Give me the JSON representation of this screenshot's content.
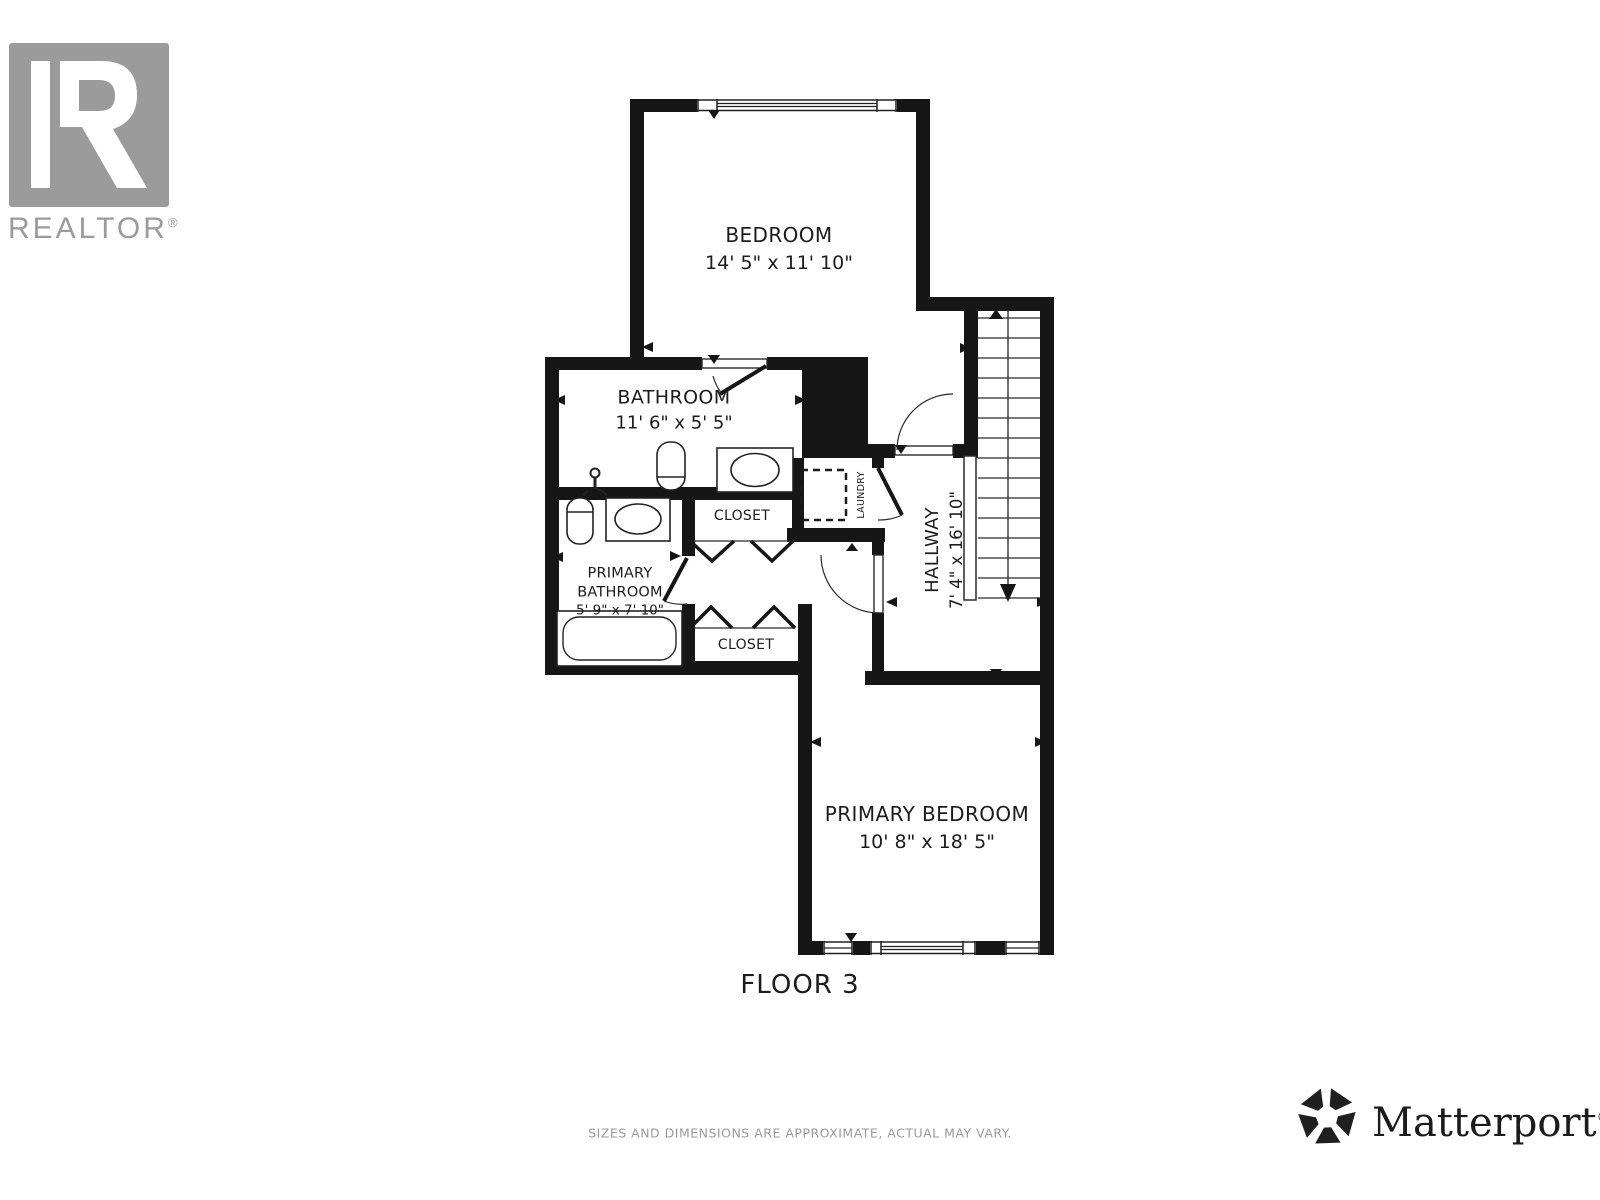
{
  "branding": {
    "realtor_logo_text": "REALTOR",
    "realtor_reg": "®",
    "matterport_text": "Matterport",
    "matterport_reg": "®",
    "logo_gray": "#9b9b9b"
  },
  "floor": {
    "label": "FLOOR 3"
  },
  "disclaimer": "SIZES AND DIMENSIONS ARE APPROXIMATE, ACTUAL MAY VARY.",
  "rooms": {
    "bedroom": {
      "name": "BEDROOM",
      "dims": "14' 5\" x 11' 10\""
    },
    "bathroom": {
      "name": "BATHROOM",
      "dims": "11' 6\" x 5' 5\""
    },
    "primary_bathroom": {
      "name_line1": "PRIMARY",
      "name_line2": "BATHROOM",
      "dims": "5' 9\" x 7' 10\""
    },
    "closet_upper": {
      "name": "CLOSET"
    },
    "closet_lower": {
      "name": "CLOSET"
    },
    "hallway": {
      "name": "HALLWAY",
      "dims": "7' 4\" x 16' 10\""
    },
    "laundry": {
      "name": "LAUNDRY"
    },
    "primary_bedroom": {
      "name": "PRIMARY BEDROOM",
      "dims": "10' 8\" x 18' 5\""
    }
  },
  "icons": {
    "realtor_r": "realtor-block-r-icon",
    "matterport_mark": "matterport-pinwheel-icon",
    "stair_direction": "stairs-down-arrow"
  },
  "colors": {
    "wall": "#161616",
    "line": "#242424",
    "text": "#1c1c1c",
    "muted": "#9a9a9a"
  }
}
